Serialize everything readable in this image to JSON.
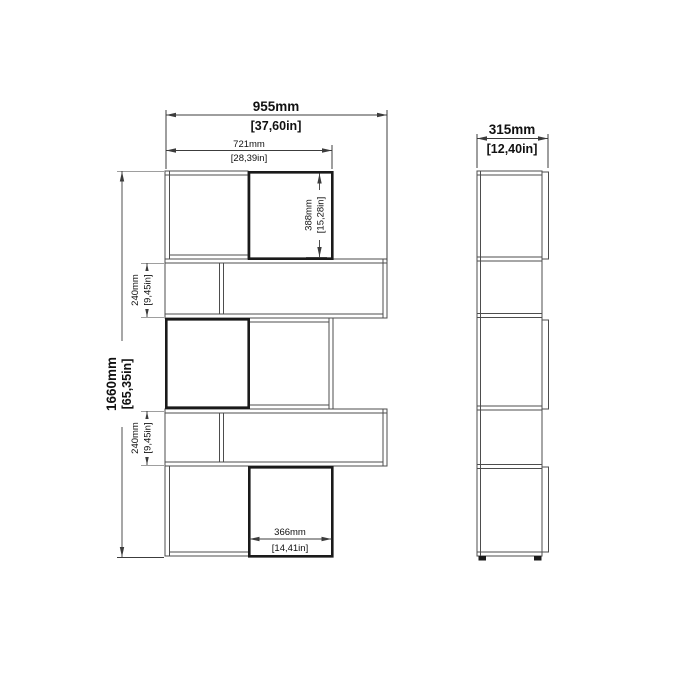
{
  "diagram": {
    "front_view": {
      "overall_width_mm": "955mm",
      "overall_width_in": "[37,60in]",
      "top_width_mm": "721mm",
      "top_width_in": "[28,39in]",
      "overall_height_mm": "1660mm",
      "overall_height_in": "[65,35in]",
      "top_section_height_mm": "388mm",
      "top_section_height_in": "[15,28in]",
      "upper_shelf_height_mm": "240mm",
      "upper_shelf_height_in": "[9,45in]",
      "lower_shelf_height_mm": "240mm",
      "lower_shelf_height_in": "[9,45in]",
      "bottom_box_width_mm": "366mm",
      "bottom_box_width_in": "[14,41in]"
    },
    "side_view": {
      "depth_mm": "315mm",
      "depth_in": "[12,40in]"
    },
    "colors": {
      "background": "#ffffff",
      "thin_line": "#4d4d4d",
      "thick_line": "#1a1a1a",
      "dim_line": "#3c3c3c",
      "text": "#111111"
    }
  }
}
